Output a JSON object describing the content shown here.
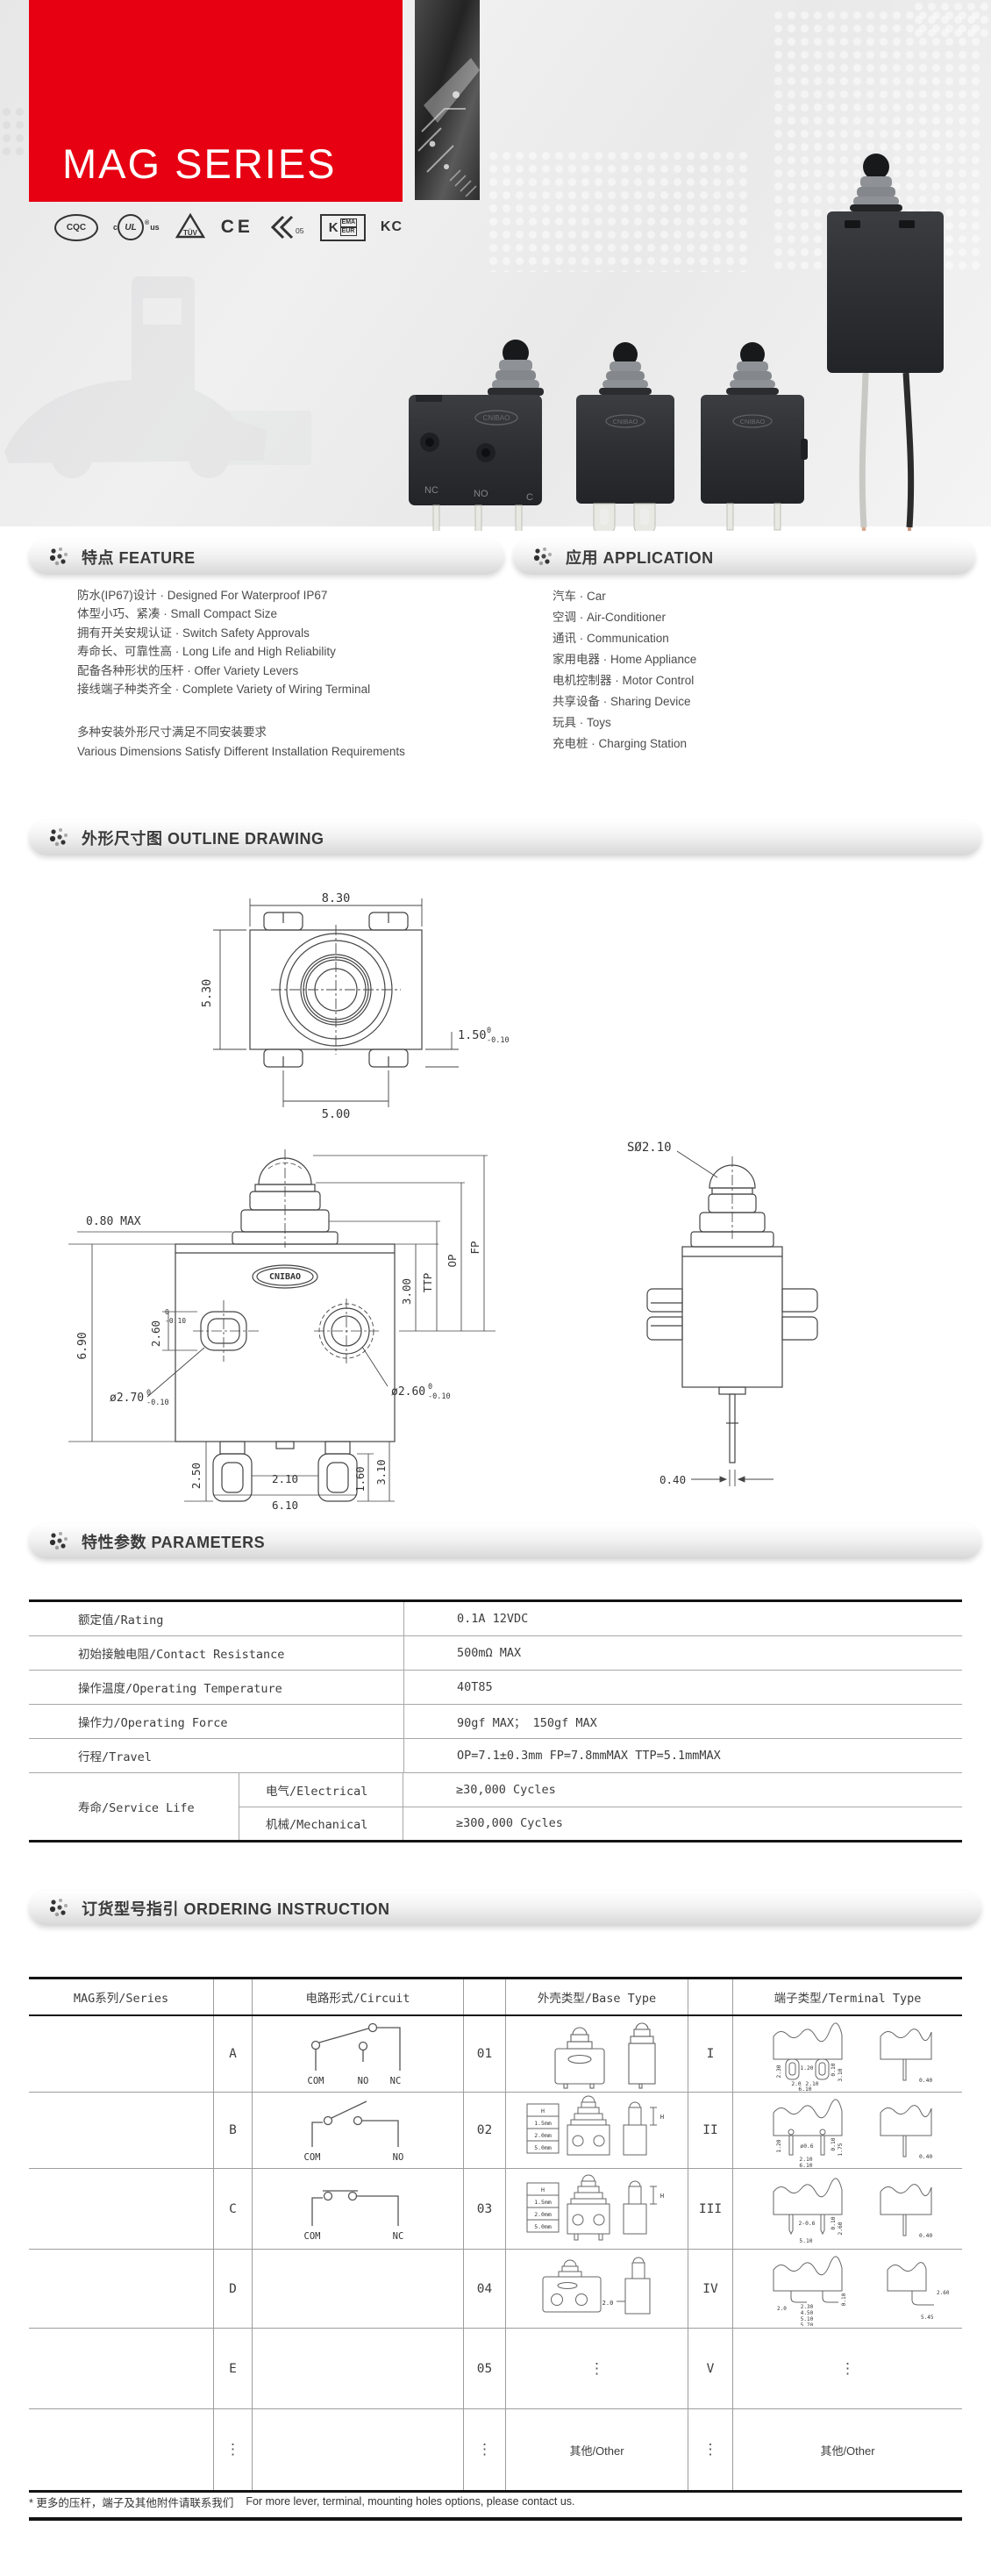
{
  "banner": {
    "title": "MAG SERIES",
    "accent_color": "#e60012"
  },
  "logos": {
    "cqc": "CQC",
    "ul_c": "c",
    "ul": "UL",
    "ul_r": "®",
    "ul_us": "us",
    "tuv": "TÜV",
    "ce": "CE",
    "emark": "05",
    "kema_k": "K",
    "kema_top": "EMA",
    "kema_bot": "EUR",
    "kc": "KC"
  },
  "products": {
    "brand": "CNIBAO",
    "sw1_labels": [
      "NC",
      "NO",
      "C"
    ]
  },
  "sections": {
    "feature": "特点 FEATURE",
    "application": "应用 APPLICATION",
    "outline": "外形尺寸图 OUTLINE DRAWING",
    "parameters": "特性参数 PARAMETERS",
    "ordering": "订货型号指引 ORDERING INSTRUCTION"
  },
  "feature": {
    "items": [
      "防水(IP67)设计 · Designed For Waterproof IP67",
      "体型小巧、紧凑 · Small Compact Size",
      "拥有开关安规认证 · Switch Safety Approvals",
      "寿命长、可靠性高 · Long Life and High Reliability",
      "配备各种形状的压杆 · Offer Variety Levers",
      "接线端子种类齐全 · Complete Variety of Wiring Terminal"
    ],
    "note_cn": "多种安装外形尺寸满足不同安装要求",
    "note_en": "Various Dimensions Satisfy Different Installation Requirements"
  },
  "application": {
    "items": [
      "汽车 · Car",
      "空调 · Air-Conditioner",
      "通讯 · Communication",
      "家用电器 · Home Appliance",
      "电机控制器 · Motor Control",
      "共享设备 · Sharing Device",
      "玩具 · Toys",
      "充电桩 · Charging Station"
    ]
  },
  "outline": {
    "brand": "CNIBAO",
    "top": {
      "w": "8.30",
      "h": "5.30",
      "b": "5.00",
      "t": "1.50",
      "tol_sup": "0",
      "tol_sub": "-0.10"
    },
    "front": {
      "d080": "0.80 MAX",
      "d690": "6.90",
      "d260": "2.60",
      "tol_sup": "0",
      "tol_sub": "-0.10",
      "d270": "ø2.70",
      "d260r": "ø2.60",
      "d300": "3.00",
      "ttp": "TTP",
      "op": "OP",
      "fp": "FP",
      "d250": "2.50",
      "d210": "2.10",
      "d610": "6.10",
      "d160": "1.60",
      "d310": "3.10"
    },
    "side": {
      "s210": "SØ2.10",
      "d040": "0.40"
    }
  },
  "parameters": {
    "rows": [
      {
        "label": "额定值/Rating",
        "value": "0.1A 12VDC"
      },
      {
        "label": "初始接触电阻/Contact Resistance",
        "value": "500mΩ MAX"
      },
      {
        "label": "操作温度/Operating Temperature",
        "value": "40T85"
      },
      {
        "label": "操作力/Operating Force",
        "value": "90gf MAX；  150gf MAX"
      },
      {
        "label": "行程/Travel",
        "value": "OP=7.1±0.3mm  FP=7.8mmMAX  TTP=5.1mmMAX"
      }
    ],
    "service": {
      "label": "寿命/Service Life",
      "rows": [
        {
          "label": "电气/Electrical",
          "value": "≥30,000 Cycles"
        },
        {
          "label": "机械/Mechanical",
          "value": "≥300,000 Cycles"
        }
      ]
    }
  },
  "ordering": {
    "headers": [
      "MAG系列/Series",
      "电路形式/Circuit",
      "外壳类型/Base Type",
      "端子类型/Terminal Type"
    ],
    "letters": [
      "A",
      "B",
      "C",
      "D",
      "E",
      "⋮"
    ],
    "codes": [
      "01",
      "02",
      "03",
      "04",
      "05",
      "⋮"
    ],
    "romans": [
      "I",
      "II",
      "III",
      "IV",
      "V",
      "⋮"
    ],
    "circuit_a": [
      "COM",
      "NO",
      "NC"
    ],
    "circuit_b": [
      "COM",
      "NO"
    ],
    "circuit_c": [
      "COM",
      "NC"
    ],
    "h_table": [
      "H",
      "1.5mm",
      "2.0mm",
      "5.0mm"
    ],
    "base_h": "H",
    "base_d20": "2.0",
    "base_other": "其他/Other",
    "terminal_other": "其他/Other",
    "t1": [
      "2.30",
      "1.20",
      "0.10",
      "3.10",
      "2.0",
      "2.10",
      "6.10",
      "0.40"
    ],
    "t2": [
      "1.20",
      "ø0.6",
      "0.10",
      "1.75",
      "2.10",
      "6.10",
      "0.40"
    ],
    "t3": [
      "2-0.6",
      "0.10",
      "2.60",
      "5.10",
      "0.40"
    ],
    "t4": [
      "0.10",
      "2.30",
      "4.50",
      "5.10",
      "5.70",
      "2.0",
      "2.60",
      "5.45"
    ]
  },
  "footer": {
    "note_cn": "* 更多的压杆，端子及其他附件请联系我们",
    "note_en": "For more lever, terminal, mounting holes options, please contact us."
  }
}
